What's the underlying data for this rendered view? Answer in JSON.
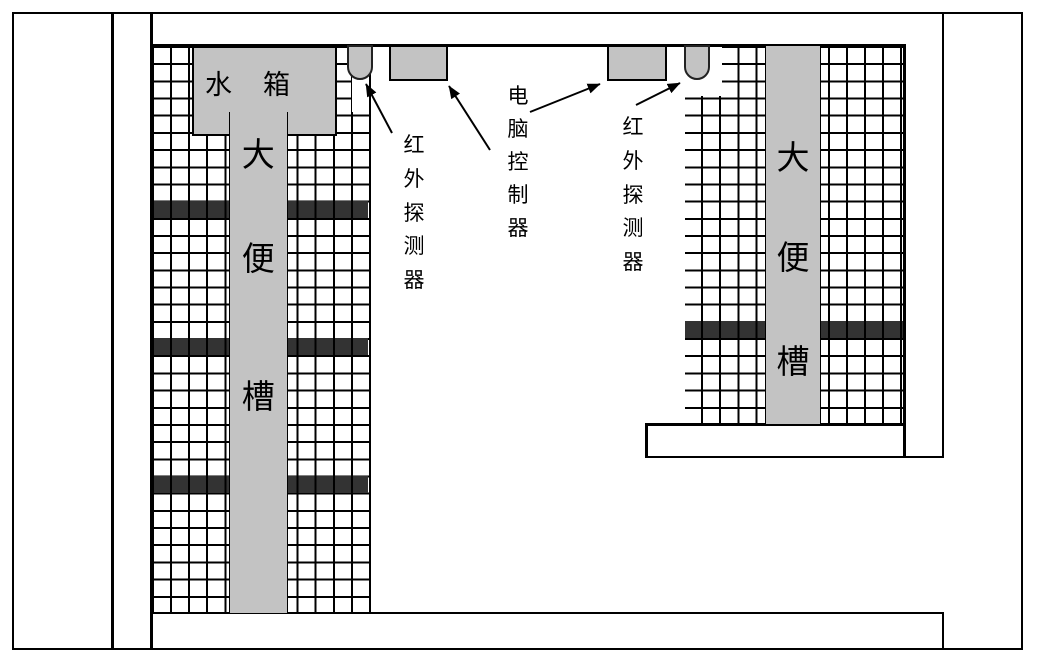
{
  "colors": {
    "structure_gray": "#c3c3c3",
    "partition_dark": "#333333",
    "line_black": "#000000"
  },
  "water_tank": {
    "text": "水箱",
    "chars": [
      "水",
      "箱"
    ]
  },
  "left_trough": {
    "text": "大便槽",
    "chars": [
      "大",
      "便",
      "槽"
    ]
  },
  "right_trough": {
    "text": "大便槽",
    "chars": [
      "大",
      "便",
      "槽"
    ]
  },
  "labels": {
    "left_ir": {
      "text": "红外探测器",
      "chars": [
        "红",
        "外",
        "探",
        "测",
        "器"
      ]
    },
    "controller": {
      "text": "电脑控制器",
      "chars": [
        "电",
        "脑",
        "控",
        "制",
        "器"
      ]
    },
    "right_ir": {
      "text": "红外探测器",
      "chars": [
        "红",
        "外",
        "探",
        "测",
        "器"
      ]
    }
  }
}
